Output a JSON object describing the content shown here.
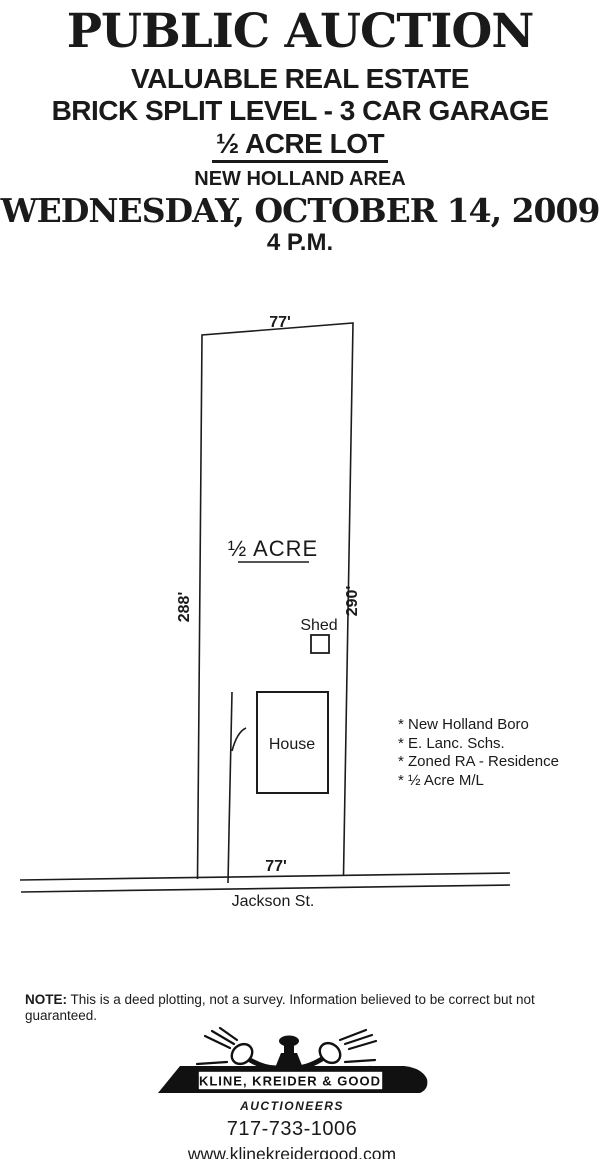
{
  "page": {
    "background": "#ffffff",
    "ink": "#1a1a1a"
  },
  "header": {
    "title": "PUBLIC AUCTION",
    "subtitle1": "VALUABLE REAL ESTATE",
    "subtitle2": "BRICK SPLIT LEVEL - 3 CAR GARAGE",
    "subtitle3": "½ ACRE LOT",
    "subtitle4": "NEW HOLLAND AREA",
    "date_line": "WEDNESDAY, OCTOBER 14, 2009",
    "time_line": "4 P.M."
  },
  "plot": {
    "top_width_label": "77'",
    "left_side_label": "288'",
    "right_side_label": "290'",
    "bottom_width_label": "77'",
    "area_label": "½ ACRE",
    "shed_label": "Shed",
    "house_label": "House",
    "street_label": "Jackson St."
  },
  "features": {
    "items": [
      "* New Holland Boro",
      "* E. Lanc. Schs.",
      "* Zoned RA - Residence",
      "* ½ Acre M/L"
    ]
  },
  "note": {
    "label": "NOTE:",
    "text": " This is a deed plotting, not a survey. Information believed to be correct but not guaranteed."
  },
  "footer": {
    "company": "KLINE, KREIDER & GOOD",
    "role": "AUCTIONEERS",
    "phone": "717-733-1006",
    "website": "www.klinekreidergood.com",
    "logo_icon": "crossed-gavels-icon"
  }
}
